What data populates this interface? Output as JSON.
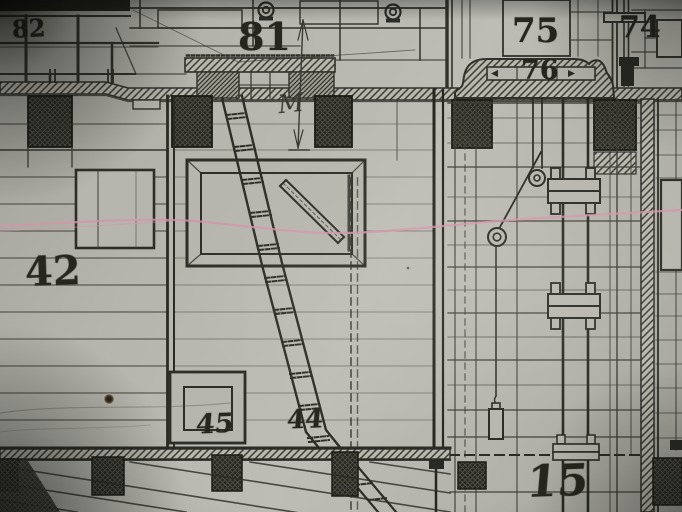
{
  "drawing": {
    "labels": {
      "c82": "82",
      "c81": "81",
      "c75": "75",
      "c76": "76",
      "c74": "74",
      "c42": "42",
      "c45": "45",
      "c44": "44",
      "c15": "15"
    },
    "annotation": {
      "handwritten_m": "M"
    },
    "colors": {
      "paper": "#b6b6ae",
      "ink": "#32322b",
      "dark_fill": "#26261f",
      "highlight_pink": "#d495a6"
    }
  }
}
